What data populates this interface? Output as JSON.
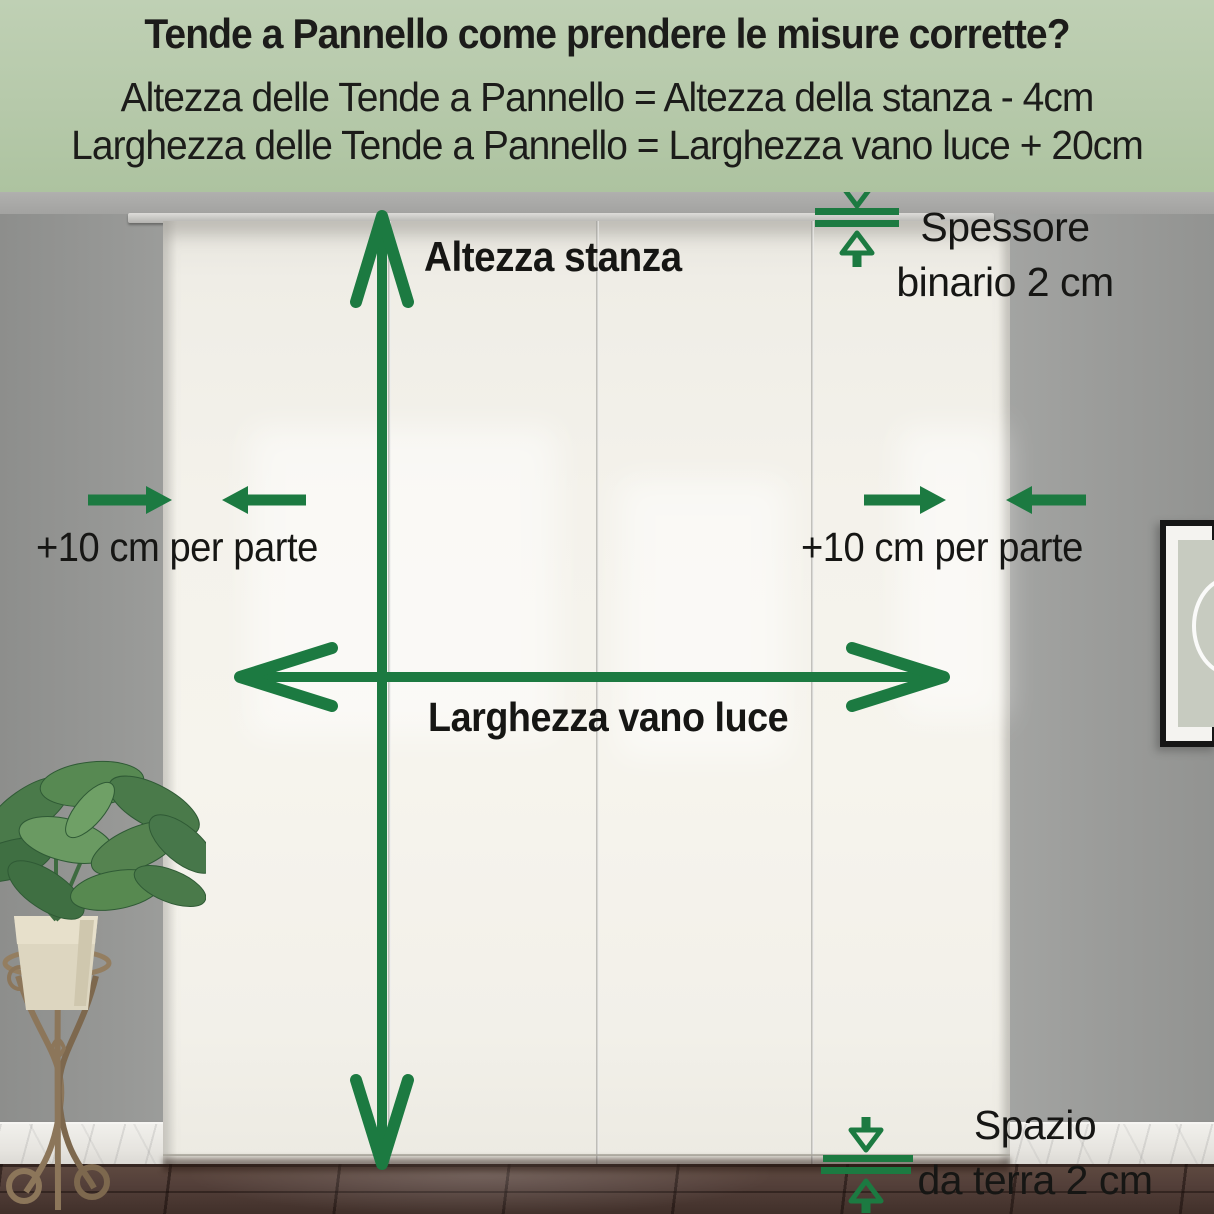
{
  "header": {
    "title": "Tende a Pannello come prendere le misure corrette?",
    "formula_height": "Altezza delle Tende a Pannello = Altezza della stanza - 4cm",
    "formula_width": "Larghezza delle Tende a Pannello = Larghezza vano luce + 20cm"
  },
  "diagram": {
    "room_height_label": "Altezza stanza",
    "opening_width_label": "Larghezza vano luce",
    "left_side_allowance_label": "+10 cm per parte",
    "right_side_allowance_label": "+10 cm per parte",
    "rail_thickness_label": {
      "line1": "Spessore",
      "line2": "binario 2 cm"
    },
    "floor_gap_label": {
      "line1": "Spazio",
      "line2": "da terra 2 cm"
    }
  },
  "colors": {
    "accent_green": "#1c7a41",
    "header_background": "#b6c9aa",
    "text": "#1c1c1a",
    "curtain": "#f4f2eb",
    "wall": "#9c9d9b",
    "floor": "#54403a"
  }
}
